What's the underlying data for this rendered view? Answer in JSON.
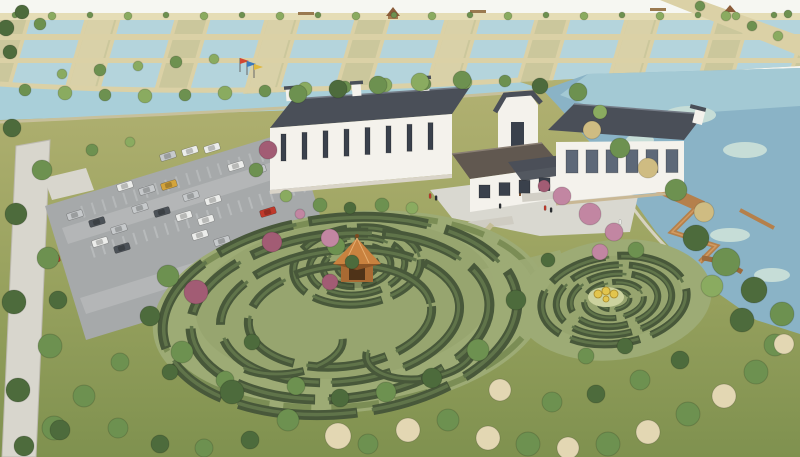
{
  "palette": {
    "sky": "#f6f7f2",
    "pondWater": "#b4d4dc",
    "canalWater": "#a9cfd9",
    "lakeWater": "#8ab3c6",
    "lakeTop": "#a7ccd6",
    "lakeLight": "#c6ddd7",
    "field": "#cbc79c",
    "fieldLight": "#d9d1a8",
    "path": "#dbd1a6",
    "walkway": "#e5ddb6",
    "grassTop": "#b2b172",
    "grassMid": "#9aa360",
    "grassDark": "#7f914f",
    "treeGreen": "#6d9150",
    "treeDark": "#4d6b3c",
    "treeLight": "#8aab60",
    "treeTan": "#cfbc82",
    "treePink": "#c286a2",
    "treeRed": "#a25c74",
    "treeCream": "#e3d7b3",
    "hedge": "#48583a",
    "hedgeTop": "#60744a",
    "mazeGround": "#9dab75",
    "mazeInner": "#92a16b",
    "roofDark": "#4a4f58",
    "roofLight": "#747b86",
    "roofBrown": "#615850",
    "wallWhite": "#f4f2ec",
    "wallShade": "#d9d4c8",
    "windowDark": "#3a414c",
    "windowGlass": "#5d6878",
    "pavement": "#a6a9aa",
    "pavementLight": "#bfc1c1",
    "curb": "#8b8e90",
    "plaza": "#d9d8d0",
    "road": "#d8d6cd",
    "wood": "#b5804b",
    "woodDark": "#9c6a3c",
    "gazeboRoof": "#c9823f",
    "gazeboBody": "#a86a33",
    "gazeboOpen": "#4f3318",
    "carWhite": "#ecedeb",
    "carSilver": "#c6c9cb",
    "carDark": "#4c5258",
    "carBlack": "#2c3034",
    "carRed": "#c0392b",
    "carYellow": "#d4a43c",
    "carGreen": "#b3bd4e",
    "flagRed": "#d24632",
    "flagBlue": "#3a7abf",
    "flagYellow": "#e0b83c",
    "stall": "#cdd0d1",
    "figureYellow": "#e2c54d"
  },
  "scene": {
    "treeColorMap": {
      "g": "treeGreen",
      "d": "treeDark",
      "l": "treeLight",
      "t": "treeTan",
      "p": "treePink",
      "r": "treeRed",
      "c": "treeCream"
    },
    "grid": {
      "ponds": [
        34,
        124,
        214,
        304,
        394,
        484,
        574,
        664,
        754
      ],
      "pondW": 58,
      "lightFields": [
        94,
        274,
        454,
        634
      ],
      "lightW": 26,
      "y": 13,
      "h": 85
    },
    "trees": [
      [
        15,
        15,
        3,
        "g"
      ],
      [
        52,
        16,
        4,
        "l"
      ],
      [
        90,
        15,
        3,
        "g"
      ],
      [
        128,
        16,
        4,
        "l"
      ],
      [
        166,
        15,
        3,
        "g"
      ],
      [
        204,
        16,
        4,
        "l"
      ],
      [
        242,
        15,
        3,
        "g"
      ],
      [
        280,
        16,
        4,
        "l"
      ],
      [
        318,
        15,
        3,
        "g"
      ],
      [
        356,
        16,
        4,
        "l"
      ],
      [
        394,
        15,
        3,
        "g"
      ],
      [
        432,
        16,
        4,
        "l"
      ],
      [
        470,
        15,
        3,
        "g"
      ],
      [
        508,
        16,
        4,
        "l"
      ],
      [
        546,
        15,
        3,
        "g"
      ],
      [
        584,
        16,
        4,
        "l"
      ],
      [
        622,
        15,
        3,
        "g"
      ],
      [
        660,
        16,
        4,
        "l"
      ],
      [
        698,
        15,
        3,
        "g"
      ],
      [
        736,
        16,
        4,
        "l"
      ],
      [
        774,
        15,
        3,
        "g"
      ],
      [
        6,
        28,
        8,
        "d"
      ],
      [
        22,
        12,
        7,
        "d"
      ],
      [
        40,
        24,
        6,
        "g"
      ],
      [
        10,
        52,
        7,
        "d"
      ],
      [
        700,
        6,
        5,
        "g"
      ],
      [
        726,
        16,
        5,
        "l"
      ],
      [
        752,
        26,
        5,
        "g"
      ],
      [
        778,
        36,
        5,
        "l"
      ],
      [
        788,
        14,
        4,
        "g"
      ],
      [
        25,
        90,
        6,
        "g"
      ],
      [
        65,
        93,
        7,
        "l"
      ],
      [
        105,
        95,
        6,
        "g"
      ],
      [
        145,
        96,
        7,
        "l"
      ],
      [
        185,
        95,
        6,
        "g"
      ],
      [
        225,
        93,
        7,
        "l"
      ],
      [
        265,
        91,
        6,
        "g"
      ],
      [
        305,
        89,
        7,
        "l"
      ],
      [
        345,
        87,
        6,
        "g"
      ],
      [
        385,
        85,
        7,
        "l"
      ],
      [
        425,
        84,
        6,
        "g"
      ],
      [
        465,
        82,
        7,
        "l"
      ],
      [
        505,
        81,
        6,
        "g"
      ],
      [
        62,
        74,
        5,
        "l"
      ],
      [
        100,
        70,
        6,
        "g"
      ],
      [
        138,
        66,
        5,
        "l"
      ],
      [
        176,
        62,
        6,
        "g"
      ],
      [
        214,
        59,
        5,
        "l"
      ],
      [
        298,
        94,
        9,
        "g"
      ],
      [
        338,
        89,
        9,
        "d"
      ],
      [
        378,
        85,
        9,
        "g"
      ],
      [
        420,
        82,
        9,
        "l"
      ],
      [
        462,
        80,
        9,
        "g"
      ],
      [
        540,
        86,
        8,
        "d"
      ],
      [
        578,
        92,
        9,
        "g"
      ],
      [
        592,
        130,
        9,
        "t"
      ],
      [
        620,
        148,
        10,
        "g"
      ],
      [
        648,
        168,
        10,
        "t"
      ],
      [
        676,
        190,
        11,
        "g"
      ],
      [
        704,
        212,
        10,
        "t"
      ],
      [
        600,
        112,
        7,
        "l"
      ],
      [
        696,
        238,
        13,
        "d"
      ],
      [
        726,
        262,
        14,
        "g"
      ],
      [
        754,
        290,
        13,
        "d"
      ],
      [
        782,
        314,
        12,
        "g"
      ],
      [
        712,
        286,
        11,
        "l"
      ],
      [
        742,
        320,
        12,
        "d"
      ],
      [
        775,
        345,
        11,
        "g"
      ],
      [
        268,
        150,
        9,
        "r"
      ],
      [
        256,
        170,
        7,
        "g"
      ],
      [
        286,
        196,
        6,
        "l"
      ],
      [
        320,
        205,
        7,
        "g"
      ],
      [
        350,
        208,
        6,
        "d"
      ],
      [
        382,
        205,
        7,
        "g"
      ],
      [
        412,
        208,
        6,
        "l"
      ],
      [
        300,
        214,
        5,
        "p"
      ],
      [
        562,
        196,
        9,
        "p"
      ],
      [
        590,
        214,
        11,
        "p"
      ],
      [
        614,
        232,
        9,
        "p"
      ],
      [
        544,
        186,
        6,
        "r"
      ],
      [
        636,
        250,
        8,
        "g"
      ],
      [
        92,
        150,
        6,
        "g"
      ],
      [
        130,
        142,
        5,
        "l"
      ],
      [
        336,
        246,
        9,
        "g"
      ],
      [
        330,
        282,
        8,
        "r"
      ],
      [
        352,
        262,
        7,
        "d"
      ],
      [
        58,
        300,
        9,
        "d"
      ],
      [
        120,
        362,
        9,
        "g"
      ],
      [
        170,
        372,
        8,
        "d"
      ],
      [
        225,
        380,
        9,
        "g"
      ],
      [
        12,
        128,
        9,
        "d"
      ],
      [
        42,
        170,
        10,
        "g"
      ],
      [
        16,
        214,
        11,
        "d"
      ],
      [
        48,
        258,
        11,
        "g"
      ],
      [
        14,
        302,
        12,
        "d"
      ],
      [
        50,
        346,
        12,
        "g"
      ],
      [
        18,
        390,
        12,
        "d"
      ],
      [
        54,
        428,
        12,
        "g"
      ],
      [
        24,
        446,
        10,
        "d"
      ],
      [
        168,
        276,
        11,
        "g"
      ],
      [
        150,
        316,
        10,
        "d"
      ],
      [
        182,
        352,
        11,
        "g"
      ],
      [
        232,
        392,
        12,
        "d"
      ],
      [
        196,
        292,
        12,
        "r"
      ],
      [
        272,
        242,
        10,
        "r"
      ],
      [
        330,
        238,
        9,
        "p"
      ],
      [
        288,
        420,
        11,
        "g"
      ],
      [
        338,
        436,
        13,
        "c"
      ],
      [
        368,
        444,
        10,
        "g"
      ],
      [
        408,
        430,
        12,
        "c"
      ],
      [
        448,
        420,
        11,
        "g"
      ],
      [
        488,
        438,
        12,
        "c"
      ],
      [
        528,
        444,
        12,
        "g"
      ],
      [
        568,
        448,
        11,
        "c"
      ],
      [
        608,
        444,
        12,
        "g"
      ],
      [
        648,
        432,
        12,
        "c"
      ],
      [
        688,
        414,
        12,
        "g"
      ],
      [
        724,
        396,
        12,
        "c"
      ],
      [
        756,
        372,
        12,
        "g"
      ],
      [
        784,
        344,
        10,
        "c"
      ],
      [
        600,
        252,
        8,
        "p"
      ],
      [
        548,
        260,
        7,
        "d"
      ],
      [
        516,
        300,
        10,
        "d"
      ],
      [
        478,
        350,
        11,
        "g"
      ],
      [
        432,
        378,
        10,
        "d"
      ],
      [
        386,
        392,
        10,
        "g"
      ],
      [
        340,
        398,
        9,
        "d"
      ],
      [
        296,
        386,
        9,
        "g"
      ],
      [
        252,
        342,
        8,
        "d"
      ],
      [
        500,
        390,
        11,
        "c"
      ],
      [
        552,
        402,
        10,
        "g"
      ],
      [
        596,
        394,
        9,
        "d"
      ],
      [
        640,
        380,
        10,
        "g"
      ],
      [
        680,
        360,
        9,
        "d"
      ],
      [
        586,
        356,
        8,
        "g"
      ],
      [
        625,
        346,
        8,
        "d"
      ],
      [
        84,
        396,
        11,
        "g"
      ],
      [
        60,
        430,
        10,
        "d"
      ],
      [
        118,
        428,
        10,
        "g"
      ],
      [
        160,
        444,
        9,
        "d"
      ],
      [
        204,
        448,
        9,
        "g"
      ],
      [
        250,
        440,
        9,
        "d"
      ]
    ],
    "cars": [
      [
        168,
        156,
        "carSilver"
      ],
      [
        190,
        151,
        "carWhite"
      ],
      [
        212,
        148,
        "carWhite"
      ],
      [
        236,
        166,
        "carWhite"
      ],
      [
        258,
        170,
        "carSilver"
      ],
      [
        125,
        186,
        "carWhite"
      ],
      [
        147,
        190,
        "carSilver"
      ],
      [
        169,
        185,
        "carYellow"
      ],
      [
        191,
        196,
        "carSilver"
      ],
      [
        213,
        200,
        "carWhite"
      ],
      [
        140,
        208,
        "carSilver"
      ],
      [
        162,
        212,
        "carDark"
      ],
      [
        184,
        216,
        "carWhite"
      ],
      [
        206,
        220,
        "carWhite"
      ],
      [
        75,
        215,
        "carSilver"
      ],
      [
        97,
        222,
        "carDark"
      ],
      [
        119,
        229,
        "carSilver"
      ],
      [
        100,
        242,
        "carWhite"
      ],
      [
        122,
        248,
        "carDark"
      ],
      [
        200,
        235,
        "carWhite"
      ],
      [
        222,
        241,
        "carSilver"
      ],
      [
        246,
        250,
        "carGreen"
      ],
      [
        268,
        212,
        "carRed"
      ],
      [
        52,
        260,
        "carRed"
      ],
      [
        238,
        298,
        "carDark"
      ],
      [
        260,
        305,
        "carWhite"
      ]
    ],
    "mazes": [
      {
        "cx": 357,
        "cy": 266,
        "ryf": 0.6,
        "rot": -6,
        "rings": [
          [
            20,
            6,
            "26 6 34 7 18 6"
          ],
          [
            34,
            7,
            "40 8 52 9 30 8"
          ],
          [
            48,
            7,
            "30 9 55 8 45 9 20 8"
          ],
          [
            64,
            8,
            "50 10 70 9 40 10"
          ]
        ]
      },
      {
        "cx": 340,
        "cy": 316,
        "ryf": 0.55,
        "rot": -6,
        "rings": [
          [
            92,
            9,
            "60 12 80 14 70 12 40 14"
          ],
          [
            120,
            9,
            "90 14 60 12 110 16 50 12"
          ],
          [
            150,
            10,
            "70 16 120 14 80 16 60 14"
          ],
          [
            178,
            10,
            "100 18 80 16 120 18 60 16"
          ]
        ]
      },
      {
        "cx": 614,
        "cy": 300,
        "ryf": 0.6,
        "rot": -7,
        "rings": [
          [
            16,
            5,
            "20 6 26 7"
          ],
          [
            30,
            6,
            "30 8 40 9 20 8"
          ],
          [
            44,
            7,
            "36 9 50 10 30 9"
          ],
          [
            58,
            7,
            "50 10 60 11 40 10"
          ],
          [
            73,
            8,
            "60 12 70 12 50 12"
          ]
        ]
      },
      {
        "cx": 285,
        "cy": 345,
        "ryf": 0.5,
        "rot": -6,
        "rings": [
          [
            58,
            8,
            "40 14 60 200"
          ]
        ]
      },
      {
        "cx": 420,
        "cy": 352,
        "ryf": 0.5,
        "rot": -6,
        "rings": [
          [
            54,
            8,
            "50 16 70 260"
          ]
        ]
      }
    ],
    "windows": [
      {
        "x0": 281,
        "y0": 134,
        "dx": 21,
        "slope": -0.077,
        "n": 8,
        "w": 5,
        "h": 27,
        "key": "windowDark"
      },
      {
        "x0": 479,
        "y0": 185,
        "dx": 20,
        "slope": -0.12,
        "n": 4,
        "w": 11,
        "h": 13,
        "key": "windowDark"
      },
      {
        "x0": 566,
        "y0": 150,
        "dx": 20,
        "slope": -0.005,
        "n": 6,
        "w": 12,
        "h": 23,
        "key": "windowGlass"
      }
    ],
    "people": [
      [
        430,
        196,
        "carRed"
      ],
      [
        436,
        198,
        "carBlack"
      ],
      [
        500,
        206,
        "carBlack"
      ],
      [
        545,
        208,
        "carRed"
      ],
      [
        551,
        210,
        "carBlack"
      ],
      [
        620,
        222,
        "carWhite"
      ]
    ],
    "flags": {
      "poles": [
        [
          240,
          58
        ],
        [
          247,
          61
        ],
        [
          254,
          64
        ]
      ],
      "colors": [
        "flagRed",
        "flagBlue",
        "flagYellow"
      ]
    },
    "figures": [
      [
        598,
        294,
        4
      ],
      [
        606,
        291,
        4
      ],
      [
        614,
        294,
        4
      ],
      [
        606,
        299,
        3
      ]
    ]
  }
}
